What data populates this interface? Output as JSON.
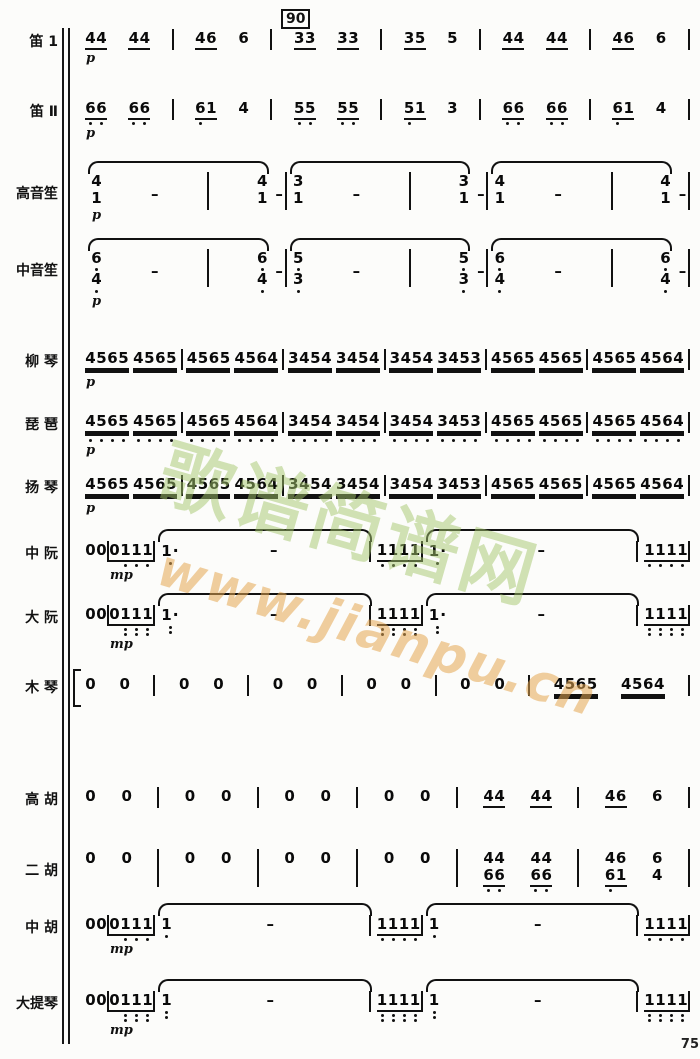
{
  "page": {
    "rehearsal_mark": "90",
    "page_number": "75"
  },
  "watermark": {
    "site_name": "歌谱简谱网",
    "site_url": "www.jianpu.cn",
    "color_green": "#a4c66c",
    "color_orange": "#e4a650"
  },
  "legend": "Tokens: '|'=barline; g=note group string (digits, '-'=dash rest-extension, ','=one low-octave dot, ';'=two low-octave dots, '.'=augmentation dot), u=underline count (1=eighth,2=sixteenth), dyn=dynamic below; cg=stacked chords [top,bottom]; arc=tie/slur bracket over contained tokens",
  "score": {
    "parts": [
      {
        "name": "笛 1",
        "line": [
          {
            "g": "44",
            "u": 1,
            "dyn": "p"
          },
          {
            "g": "44",
            "u": 1
          },
          "|",
          {
            "g": "46",
            "u": 1
          },
          {
            "g": "6"
          },
          "|",
          {
            "g": "33",
            "u": 1
          },
          {
            "g": "33",
            "u": 1
          },
          "|",
          {
            "g": "35",
            "u": 1
          },
          {
            "g": "5"
          },
          "|",
          {
            "g": "44",
            "u": 1
          },
          {
            "g": "44",
            "u": 1
          },
          "|",
          {
            "g": "46",
            "u": 1
          },
          {
            "g": "6"
          },
          "|"
        ]
      },
      {
        "name": "笛 Ⅱ",
        "line": [
          {
            "g": "6,6,",
            "u": 1,
            "dyn": "p"
          },
          {
            "g": "6,6,",
            "u": 1
          },
          "|",
          {
            "g": "6,1",
            "u": 1
          },
          {
            "g": "4"
          },
          "|",
          {
            "g": "5,5,",
            "u": 1
          },
          {
            "g": "5,5,",
            "u": 1
          },
          "|",
          {
            "g": "5,1",
            "u": 1
          },
          {
            "g": "3"
          },
          "|",
          {
            "g": "6,6,",
            "u": 1
          },
          {
            "g": "6,6,",
            "u": 1
          },
          "|",
          {
            "g": "6,1",
            "u": 1
          },
          {
            "g": "4"
          },
          "|"
        ]
      },
      {
        "name": "高音笙",
        "line": [
          {
            "arc": [
              {
                "cg": [
                  [
                    "4",
                    "1"
                  ]
                ],
                "dyn": "p"
              },
              {
                "g": "-"
              },
              "|",
              {
                "cg": [
                  [
                    "4",
                    "1"
                  ]
                ]
              }
            ]
          },
          {
            "g": "-"
          },
          "|",
          {
            "arc": [
              {
                "cg": [
                  [
                    "3",
                    "1"
                  ]
                ]
              },
              {
                "g": "-"
              },
              "|",
              {
                "cg": [
                  [
                    "3",
                    "1"
                  ]
                ]
              }
            ]
          },
          {
            "g": "-"
          },
          "|",
          {
            "arc": [
              {
                "cg": [
                  [
                    "4",
                    "1"
                  ]
                ]
              },
              {
                "g": "-"
              },
              "|",
              {
                "cg": [
                  [
                    "4",
                    "1"
                  ]
                ]
              }
            ]
          },
          {
            "g": "-"
          },
          "|"
        ]
      },
      {
        "name": "中音笙",
        "line": [
          {
            "arc": [
              {
                "cg": [
                  [
                    "6,",
                    "4,"
                  ]
                ],
                "dyn": "p"
              },
              {
                "g": "-"
              },
              "|",
              {
                "cg": [
                  [
                    "6,",
                    "4,"
                  ]
                ]
              }
            ]
          },
          {
            "g": "-"
          },
          "|",
          {
            "arc": [
              {
                "cg": [
                  [
                    "5,",
                    "3,"
                  ]
                ]
              },
              {
                "g": "-"
              },
              "|",
              {
                "cg": [
                  [
                    "5,",
                    "3,"
                  ]
                ]
              }
            ]
          },
          {
            "g": "-"
          },
          "|",
          {
            "arc": [
              {
                "cg": [
                  [
                    "6,",
                    "4,"
                  ]
                ]
              },
              {
                "g": "-"
              },
              "|",
              {
                "cg": [
                  [
                    "6,",
                    "4,"
                  ]
                ]
              }
            ]
          },
          {
            "g": "-"
          },
          "|"
        ]
      },
      {
        "name": "柳 琴",
        "line": [
          {
            "g": "4565",
            "u": 2,
            "dyn": "p"
          },
          {
            "g": "4565",
            "u": 2
          },
          "|",
          {
            "g": "4565",
            "u": 2
          },
          {
            "g": "4564",
            "u": 2
          },
          "|",
          {
            "g": "3454",
            "u": 2
          },
          {
            "g": "3454",
            "u": 2
          },
          "|",
          {
            "g": "3454",
            "u": 2
          },
          {
            "g": "3453",
            "u": 2
          },
          "|",
          {
            "g": "4565",
            "u": 2
          },
          {
            "g": "4565",
            "u": 2
          },
          "|",
          {
            "g": "4565",
            "u": 2
          },
          {
            "g": "4564",
            "u": 2
          },
          "|"
        ]
      },
      {
        "name": "琵 琶",
        "line": [
          {
            "g": "4,5,6,5,",
            "u": 2,
            "dyn": "p"
          },
          {
            "g": "4,5,6,5,",
            "u": 2
          },
          "|",
          {
            "g": "4,5,6,5,",
            "u": 2
          },
          {
            "g": "4,5,6,4,",
            "u": 2
          },
          "|",
          {
            "g": "3,4,5,4,",
            "u": 2
          },
          {
            "g": "3,4,5,4,",
            "u": 2
          },
          "|",
          {
            "g": "3,4,5,4,",
            "u": 2
          },
          {
            "g": "3,4,5,3,",
            "u": 2
          },
          "|",
          {
            "g": "4,5,6,5,",
            "u": 2
          },
          {
            "g": "4,5,6,5,",
            "u": 2
          },
          "|",
          {
            "g": "4,5,6,5,",
            "u": 2
          },
          {
            "g": "4,5,6,4,",
            "u": 2
          },
          "|"
        ]
      },
      {
        "name": "扬 琴",
        "line": [
          {
            "g": "4565",
            "u": 2,
            "dyn": "p"
          },
          {
            "g": "4565",
            "u": 2
          },
          "|",
          {
            "g": "4565",
            "u": 2
          },
          {
            "g": "4564",
            "u": 2
          },
          "|",
          {
            "g": "3454",
            "u": 2
          },
          {
            "g": "3454",
            "u": 2
          },
          "|",
          {
            "g": "3454",
            "u": 2
          },
          {
            "g": "3453",
            "u": 2
          },
          "|",
          {
            "g": "4565",
            "u": 2
          },
          {
            "g": "4565",
            "u": 2
          },
          "|",
          {
            "g": "4565",
            "u": 2
          },
          {
            "g": "4564",
            "u": 2
          },
          "|"
        ]
      },
      {
        "name": "中 阮",
        "line": [
          {
            "g": "0"
          },
          {
            "g": "0"
          },
          "|",
          {
            "g": "01,",
            "u": 1,
            "dyn": "mp"
          },
          {
            "g": "1,1,",
            "u": 1
          },
          "|",
          {
            "arc": [
              {
                "g": "1,."
              },
              {
                "g": "-"
              },
              "|"
            ]
          },
          {
            "g": "1,1,",
            "u": 1
          },
          {
            "g": "1,1,",
            "u": 1
          },
          "|",
          {
            "arc": [
              {
                "g": "1,."
              },
              {
                "g": "-"
              },
              "|"
            ]
          },
          {
            "g": "1,1,",
            "u": 1
          },
          {
            "g": "1,1,",
            "u": 1
          },
          "|"
        ]
      },
      {
        "name": "大 阮",
        "line": [
          {
            "g": "0"
          },
          {
            "g": "0"
          },
          "|",
          {
            "g": "01;",
            "u": 1,
            "dyn": "mp"
          },
          {
            "g": "1;1;",
            "u": 1
          },
          "|",
          {
            "arc": [
              {
                "g": "1;."
              },
              {
                "g": "-"
              },
              "|"
            ]
          },
          {
            "g": "1;1;",
            "u": 1
          },
          {
            "g": "1;1;",
            "u": 1
          },
          "|",
          {
            "arc": [
              {
                "g": "1;."
              },
              {
                "g": "-"
              },
              "|"
            ]
          },
          {
            "g": "1;1;",
            "u": 1
          },
          {
            "g": "1;1;",
            "u": 1
          },
          "|"
        ]
      },
      {
        "name": "木 琴",
        "bracket": true,
        "line": [
          {
            "g": "0"
          },
          {
            "g": "0"
          },
          "|",
          {
            "g": "0"
          },
          {
            "g": "0"
          },
          "|",
          {
            "g": "0"
          },
          {
            "g": "0"
          },
          "|",
          {
            "g": "0"
          },
          {
            "g": "0"
          },
          "|",
          {
            "g": "0"
          },
          {
            "g": "0"
          },
          "|",
          {
            "g": "4565",
            "u": 2
          },
          {
            "g": "4564",
            "u": 2
          },
          "|"
        ]
      },
      {
        "name": "高 胡",
        "line": [
          {
            "g": "0"
          },
          {
            "g": "0"
          },
          "|",
          {
            "g": "0"
          },
          {
            "g": "0"
          },
          "|",
          {
            "g": "0"
          },
          {
            "g": "0"
          },
          "|",
          {
            "g": "0"
          },
          {
            "g": "0"
          },
          "|",
          {
            "g": "44",
            "u": 1
          },
          {
            "g": "44",
            "u": 1
          },
          "|",
          {
            "g": "46",
            "u": 1
          },
          {
            "g": "6"
          },
          "|"
        ]
      },
      {
        "name": "二 胡",
        "line": [
          {
            "g": "0"
          },
          {
            "g": "0"
          },
          "|",
          {
            "g": "0"
          },
          {
            "g": "0"
          },
          "|",
          {
            "g": "0"
          },
          {
            "g": "0"
          },
          "|",
          {
            "g": "0"
          },
          {
            "g": "0"
          },
          "|",
          {
            "cg": [
              [
                "4",
                "6,"
              ],
              [
                "4",
                "6,"
              ]
            ],
            "u": 1
          },
          {
            "cg": [
              [
                "4",
                "6,"
              ],
              [
                "4",
                "6,"
              ]
            ],
            "u": 1
          },
          "|",
          {
            "cg": [
              [
                "4",
                "6,"
              ],
              [
                "6",
                "1"
              ]
            ],
            "u": 1
          },
          {
            "cg": [
              [
                "6",
                "4"
              ]
            ]
          },
          "|"
        ]
      },
      {
        "name": "中 胡",
        "line": [
          {
            "g": "0"
          },
          {
            "g": "0"
          },
          "|",
          {
            "g": "01,",
            "u": 1,
            "dyn": "mp"
          },
          {
            "g": "1,1,",
            "u": 1
          },
          "|",
          {
            "arc": [
              {
                "g": "1,"
              },
              {
                "g": "-"
              },
              "|"
            ]
          },
          {
            "g": "1,1,",
            "u": 1
          },
          {
            "g": "1,1,",
            "u": 1
          },
          "|",
          {
            "arc": [
              {
                "g": "1,"
              },
              {
                "g": "-"
              },
              "|"
            ]
          },
          {
            "g": "1,1,",
            "u": 1
          },
          {
            "g": "1,1,",
            "u": 1
          },
          "|"
        ]
      },
      {
        "name": "大提琴",
        "line": [
          {
            "g": "0"
          },
          {
            "g": "0"
          },
          "|",
          {
            "g": "01;",
            "u": 1,
            "dyn": "mp"
          },
          {
            "g": "1;1;",
            "u": 1
          },
          "|",
          {
            "arc": [
              {
                "g": "1;"
              },
              {
                "g": "-"
              },
              "|"
            ]
          },
          {
            "g": "1;1;",
            "u": 1
          },
          {
            "g": "1;1;",
            "u": 1
          },
          "|",
          {
            "arc": [
              {
                "g": "1;"
              },
              {
                "g": "-"
              },
              "|"
            ]
          },
          {
            "g": "1;1;",
            "u": 1
          },
          {
            "g": "1;1;",
            "u": 1
          },
          "|"
        ]
      }
    ]
  }
}
